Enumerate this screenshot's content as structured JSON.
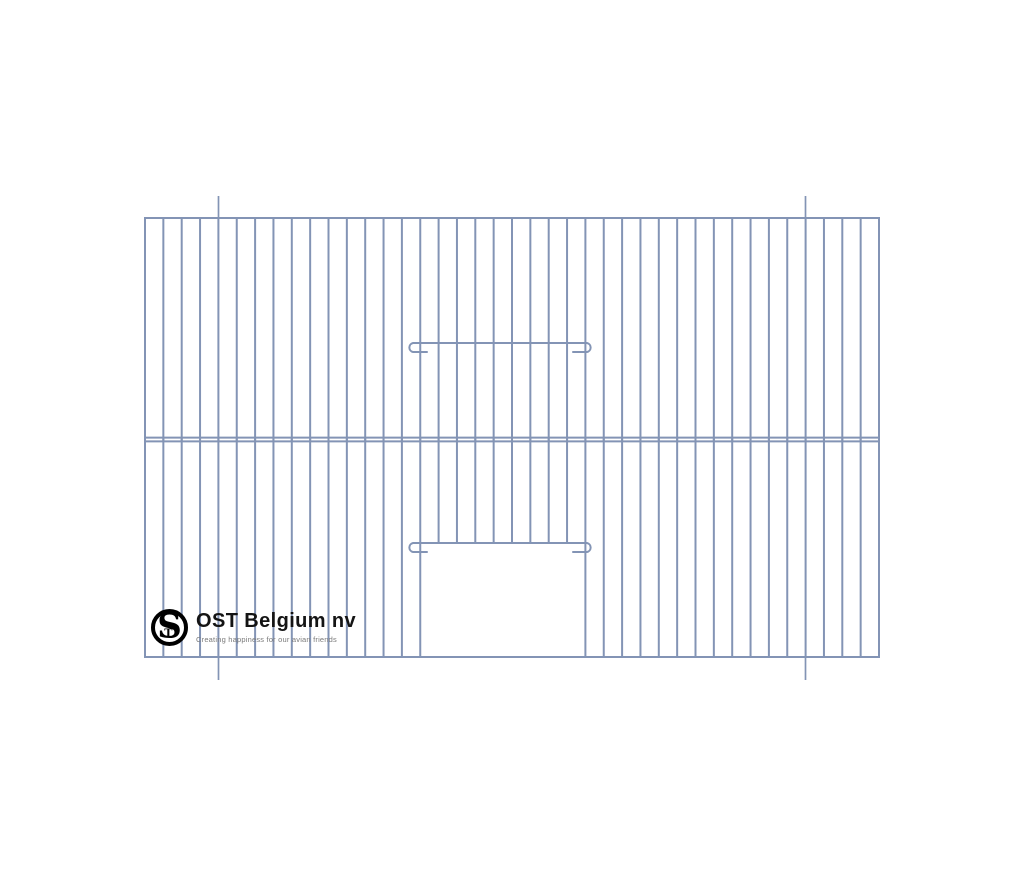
{
  "page": {
    "background": "#ffffff"
  },
  "logo": {
    "company": "OST Belgium nv",
    "tagline": "Creating happiness for our avian friends",
    "monogram": {
      "s": "S",
      "t": "T"
    },
    "text_color": "#141414",
    "tagline_color": "#7a7a7a",
    "mark_color": "#000000"
  },
  "drawing": {
    "wire_color": "#8394b5",
    "wire_width": 2,
    "tick_width": 1.7,
    "frame": {
      "left": 145,
      "top": 218,
      "right": 879,
      "bottom": 657
    },
    "gaps": 40,
    "mid_rails_y": [
      437.6,
      441.4
    ],
    "door": {
      "left_wire": 15,
      "right_wire": 24,
      "open_top": 543
    },
    "latches": [
      {
        "bar_y": 343,
        "stub_y": 352,
        "x1": 413,
        "x2": 587,
        "hook_r": 4.6,
        "stub_len": 14
      },
      {
        "bar_y": 543,
        "stub_y": 552,
        "x1": 413,
        "x2": 587,
        "hook_r": 4.6,
        "stub_len": 14
      }
    ],
    "ticks": {
      "xs": [
        218.5,
        805.5
      ],
      "top": [
        196,
        218
      ],
      "bottom": [
        657,
        680
      ]
    }
  }
}
